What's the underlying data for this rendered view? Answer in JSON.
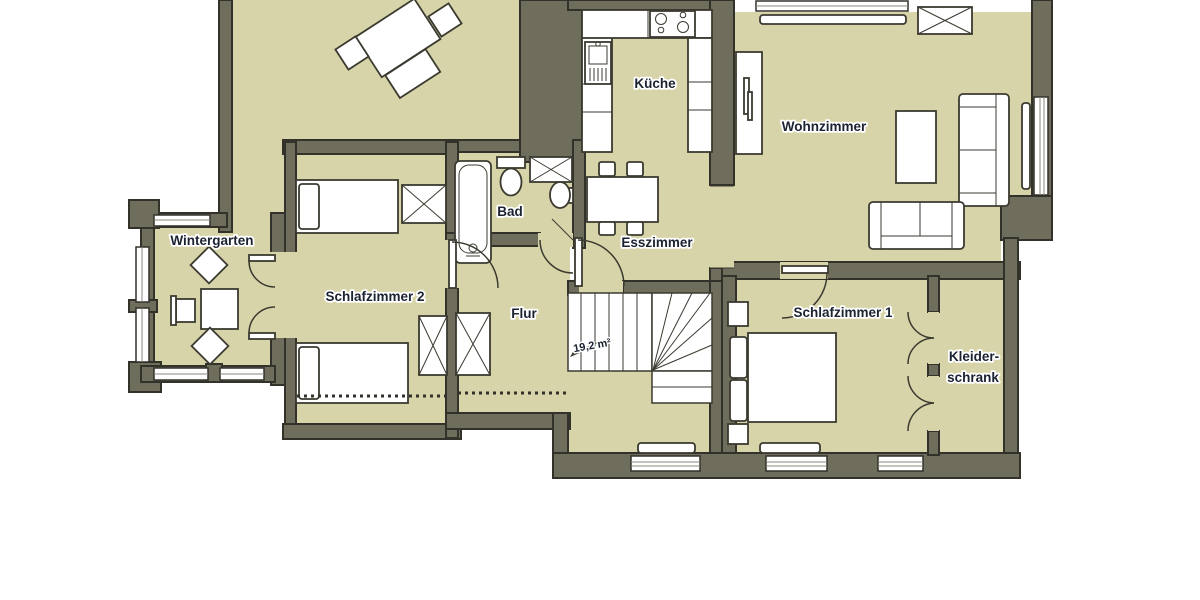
{
  "floorplan": {
    "rooms": {
      "wintergarten": "Wintergarten",
      "schlafzimmer2": "Schlafzimmer 2",
      "bad": "Bad",
      "kueche": "Küche",
      "esszimmer": "Esszimmer",
      "wohnzimmer": "Wohnzimmer",
      "schlafzimmer1": "Schlafzimmer 1",
      "kleiderschrank_line1": "Kleider-",
      "kleiderschrank_line2": "schrank",
      "flur": "Flur"
    },
    "stairs": {
      "area_label": "19,2 m²"
    },
    "colors": {
      "background": "#ffffff",
      "room_fill": "#d8d4a9",
      "wall_fill": "#6f6d5b",
      "wall_outline": "#32312a",
      "furniture_fill": "#ffffff",
      "furniture_outline": "#3b3a30",
      "label_text": "#1b2230",
      "label_halo": "#ffffff"
    },
    "furniture_icons": [
      "bed-icon",
      "double-bed-icon",
      "wardrobe-icon",
      "bathtub-icon",
      "toilet-icon",
      "washbasin-icon",
      "shower-icon",
      "kitchen-sink-icon",
      "stove-icon",
      "kitchen-counter-icon",
      "dining-table-icon",
      "chair-icon",
      "sofa-icon",
      "coffee-table-icon",
      "cabinet-icon",
      "radiator-icon",
      "stairs-icon",
      "window-icon",
      "door-arc-icon",
      "table-icon",
      "bench-icon"
    ]
  }
}
